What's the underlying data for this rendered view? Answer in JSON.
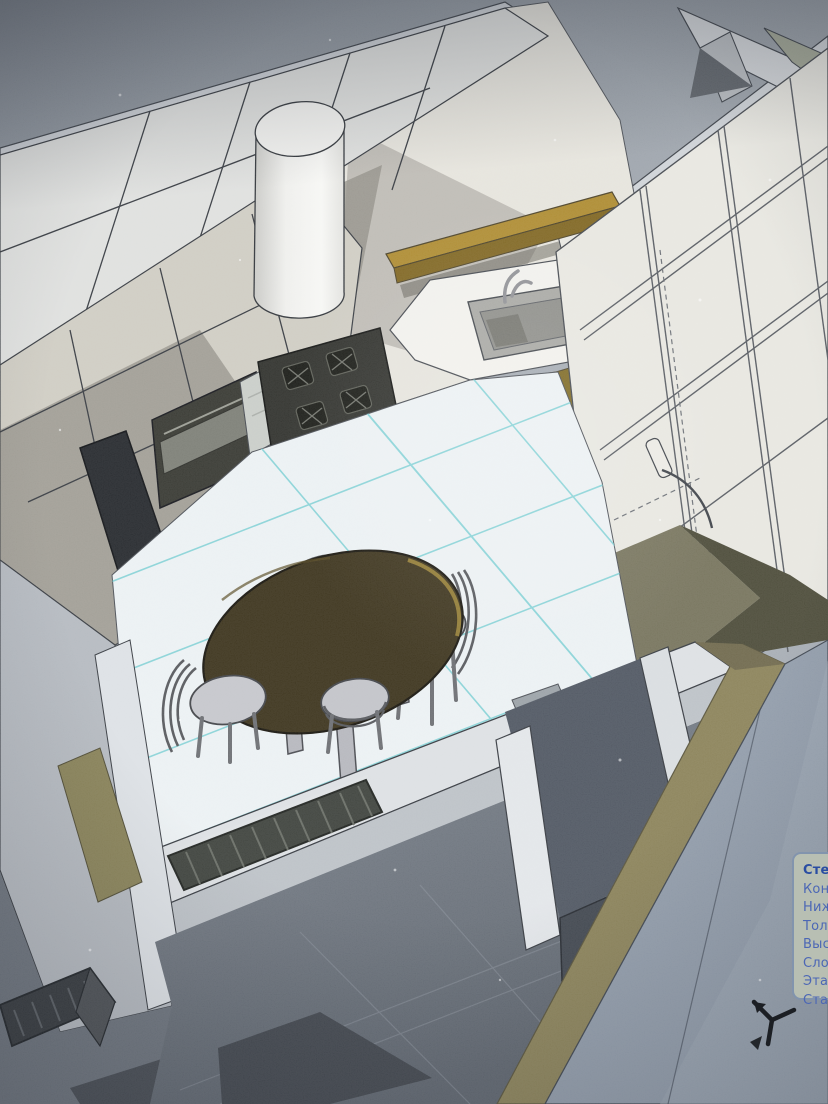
{
  "viewport": {
    "description": "photographed 3D CAD perspective view of a kitchen model",
    "scene_objects": [
      "left-wall-cabinets",
      "built-in-oven",
      "dark-panel",
      "extractor-cylinder",
      "wood-wall-shelf",
      "cooktop-4-burners",
      "sink-with-faucet",
      "wood-base-cabinets",
      "tall-cabinet-column",
      "tile-floor-with-grid",
      "oval-dining-table",
      "chair",
      "chair",
      "chair",
      "stool",
      "radiator",
      "radiator-2",
      "doorway",
      "open-door",
      "foreground-cut-wall"
    ],
    "floor_grid_color": "#7fd0d4",
    "wood_color": "#a1862f",
    "table_color": "#3a3119",
    "wall_color": "#e6e4dc",
    "shadow_color": "#a3a099",
    "cut_wall_top_color": "#8a8157",
    "foreground_wall_color": "#8e99a7"
  },
  "tooltip": {
    "title": "Стен",
    "lines": [
      "Конс",
      "Нижн",
      "Толщ",
      "Высот",
      "Слой:",
      "Этаж:",
      "Статус"
    ],
    "title_color": "#2a4da2",
    "text_color": "#4c67b5"
  },
  "cursor": {
    "icon": "cad-tripod-cursor"
  }
}
